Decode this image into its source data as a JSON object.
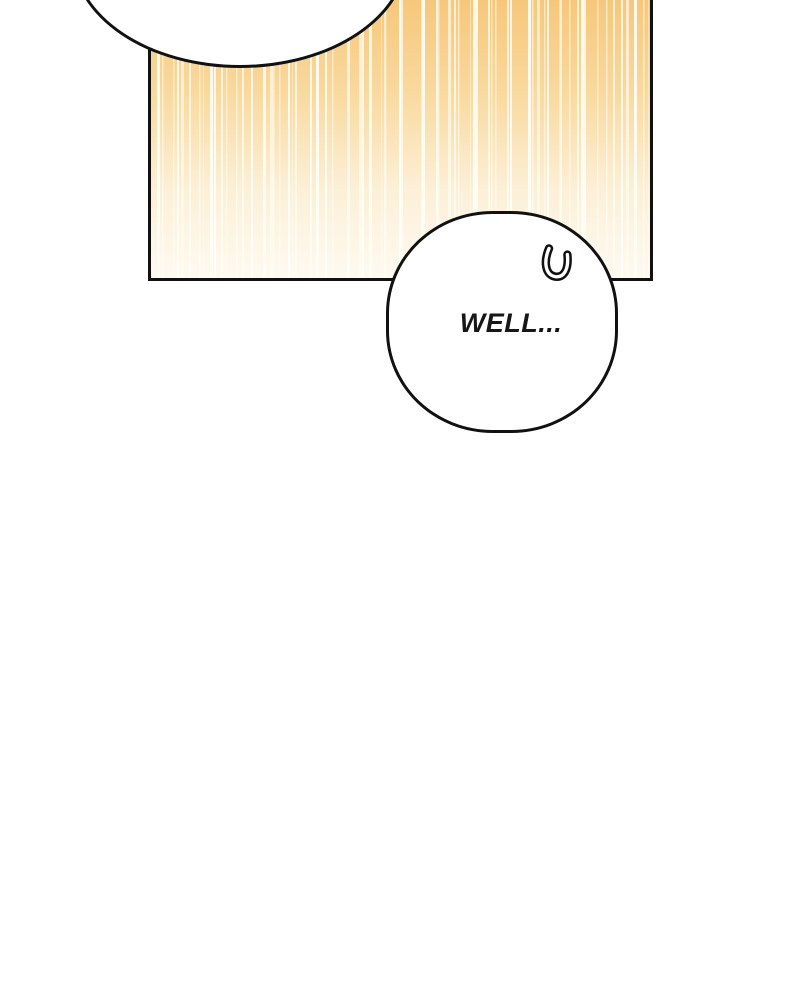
{
  "comic": {
    "panel": {
      "border_color": "#111111",
      "gradient_top_color": "#f6c678",
      "gradient_bottom_color": "#fefaf1",
      "speed_line_color": "#fffdf4"
    },
    "bubbles": {
      "top": {
        "type": "speech-bubble",
        "text": ""
      },
      "bottom": {
        "type": "speech-bubble",
        "text": "WELL...",
        "mark_icon": "u-curl-icon"
      }
    }
  }
}
